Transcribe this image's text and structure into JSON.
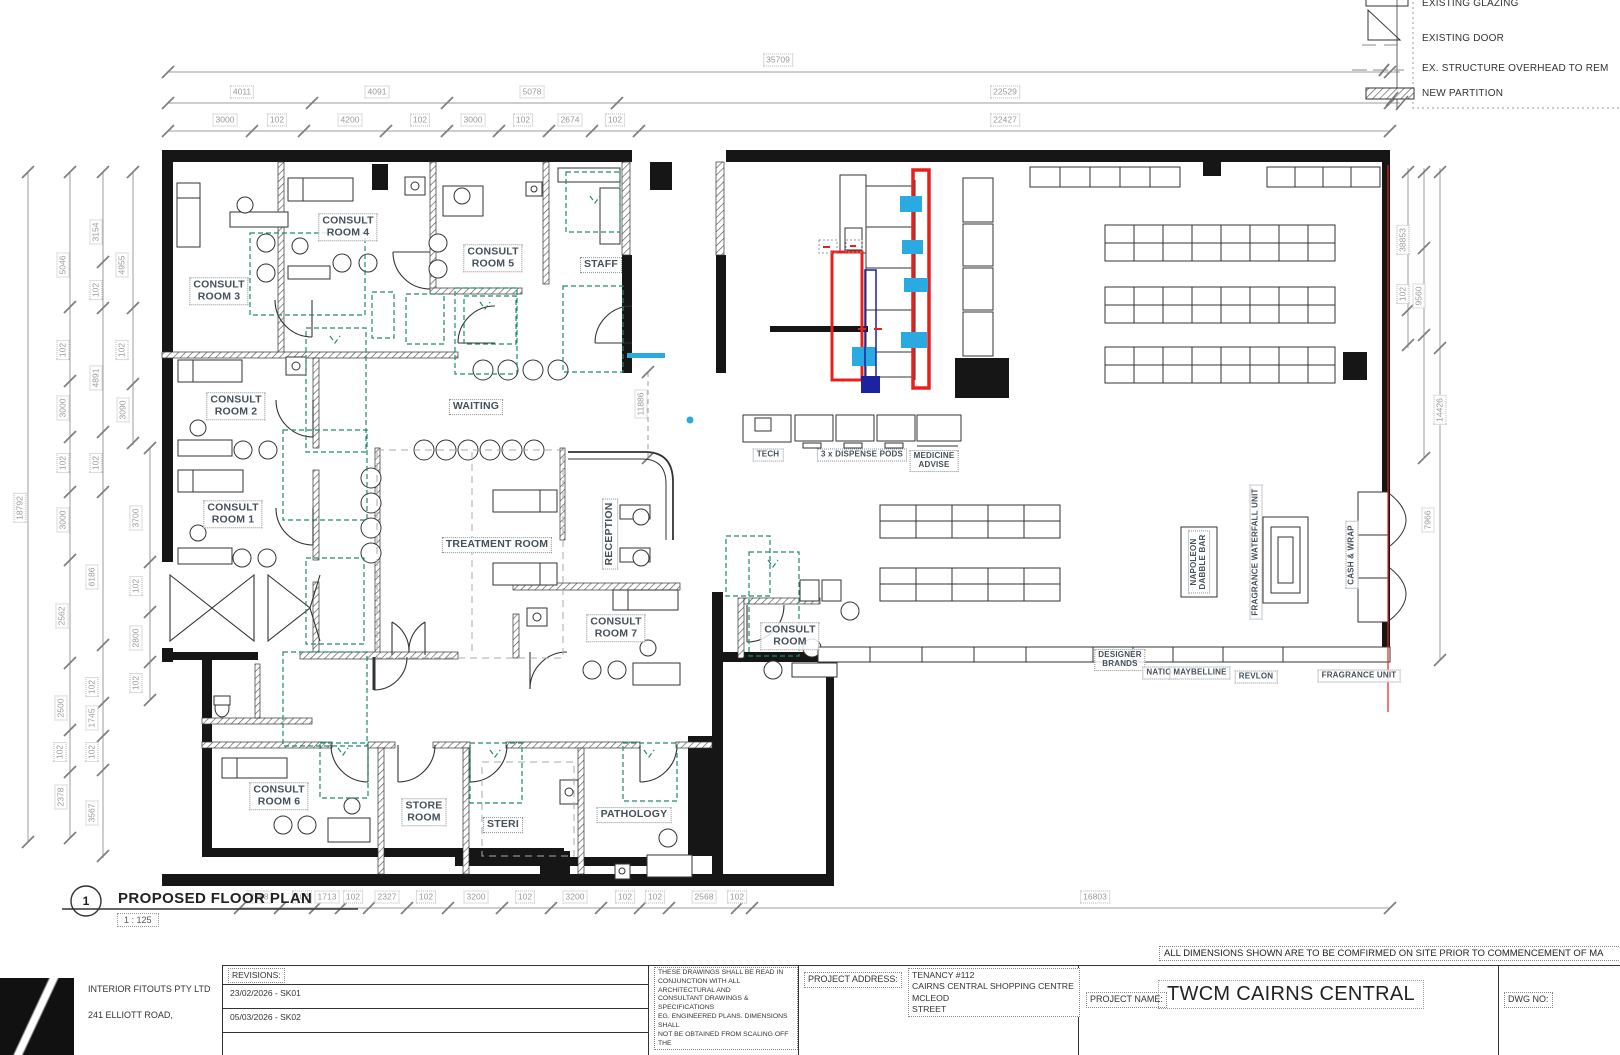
{
  "plan_title": {
    "number": "1",
    "name": "PROPOSED FLOOR PLAN",
    "scale": "1 : 125"
  },
  "note": "ALL DIMENSIONS SHOWN ARE TO BE COMFIRMED ON SITE PRIOR TO COMMENCEMENT OF MA",
  "legend": {
    "items": [
      "EXISTING GLAZING",
      "EXISTING DOOR",
      "EX. STRUCTURE OVERHEAD TO REM",
      "NEW PARTITION"
    ]
  },
  "rooms": {
    "cr1": "CONSULT\nROOM 1",
    "cr2": "CONSULT\nROOM 2",
    "cr3": "CONSULT\nROOM 3",
    "cr4": "CONSULT\nROOM 4",
    "cr5": "CONSULT\nROOM 5",
    "cr6": "CONSULT\nROOM 6",
    "cr7": "CONSULT\nROOM 7",
    "cr8": "CONSULT\nROOM",
    "staff": "STAFF",
    "waiting": "WAITING",
    "treatment": "TREATMENT ROOM",
    "reception": "RECEPTION",
    "store": "STORE\nROOM",
    "steri": "STERI",
    "pathology": "PATHOLOGY"
  },
  "fixtures": {
    "tech": "TECH",
    "pods": "3 x DISPENSE PODS",
    "medicine": "MEDICINE\nADVISE",
    "designer": "DESIGNER\nBRANDS",
    "natio": "NATIO",
    "maybelline": "MAYBELLINE",
    "revlon": "REVLON",
    "fragrance_unit": "FRAGRANCE UNIT",
    "napoleon": "NAPOLEON\nDABBLE BAR",
    "waterfall": "FRAGRANCE WATERFALL UNIT",
    "cashwrap": "CASH & WRAP"
  },
  "dims": {
    "t1": [
      "35709"
    ],
    "t2": [
      "4011",
      "4091",
      "5078",
      "22529"
    ],
    "t3": [
      "3000",
      "102",
      "4200",
      "102",
      "3000",
      "102",
      "2674",
      "102",
      "22427"
    ],
    "b": [
      "2688",
      "102",
      "1713",
      "102",
      "2327",
      "102",
      "3200",
      "102",
      "3200",
      "102",
      "102",
      "2568",
      "102",
      "16803"
    ],
    "l1": [
      "18792"
    ],
    "l2": [
      "5046",
      "102",
      "3000",
      "102",
      "3000",
      "2562",
      "2500",
      "102",
      "2378"
    ],
    "l3": [
      "3154",
      "102",
      "4891",
      "102",
      "6186",
      "102",
      "1745",
      "102",
      "3567"
    ],
    "l4": [
      "4955",
      "102",
      "3090"
    ],
    "l5": [
      "3700",
      "102",
      "2800",
      "102"
    ],
    "r1": [
      "38853",
      "102",
      "9560"
    ],
    "r2": [
      "14426",
      "7966"
    ],
    "mid": [
      "11886"
    ]
  },
  "title_block": {
    "company": "INTERIOR FITOUTS PTY LTD",
    "address": "241 ELLIOTT ROAD,",
    "revisions_label": "REVISIONS:",
    "revisions": [
      "23/02/2026 - SK01",
      "05/03/2026 - SK02"
    ],
    "disclaimer": "THESE DRAWINGS SHALL BE READ IN\nCONJUNCTION WITH ALL ARCHITECTURAL AND\nCONSULTANT DRAWINGS & SPECIFICATIONS\nEG. ENGINEERED PLANS.  DIMENSIONS SHALL\nNOT BE OBTAINED FROM SCALING OFF THE",
    "project_address_label": "PROJECT ADDRESS:",
    "project_address": "TENANCY #112\nCAIRNS CENTRAL SHOPPING CENTRE MCLEOD\nSTREET",
    "project_name_label": "PROJECT NAME:",
    "project_name": "TWCM CAIRNS CENTRAL",
    "dwg_label": "DWG NO:"
  },
  "colors": {
    "red": "#e8201d",
    "cyan": "#29abe2",
    "teal": "#1e8a70",
    "navy": "#1c22a0"
  }
}
